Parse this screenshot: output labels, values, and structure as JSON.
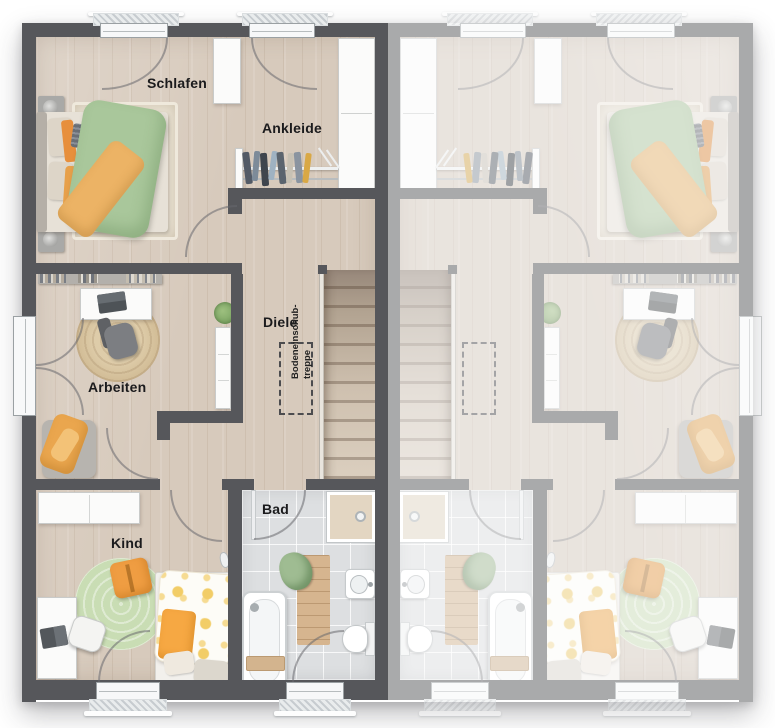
{
  "rooms": {
    "schlafen": "Schlafen",
    "ankleide": "Ankleide",
    "diele": "Diele",
    "arbeiten": "Arbeiten",
    "kind": "Kind",
    "bad": "Bad"
  },
  "annotations": {
    "attic_hatch_line1": "Bodeneinschub-",
    "attic_hatch_line2": "treppe"
  },
  "colors": {
    "wall": "#56575b",
    "floor_wood": "#d7cabc",
    "floor_tile": "#dddfe1",
    "accent_green": "#a9c79b",
    "accent_orange": "#ecb365",
    "rug_green": "#c9ddb4",
    "jute": "#d5c19c",
    "stairs_wood": "#c9bba9"
  }
}
